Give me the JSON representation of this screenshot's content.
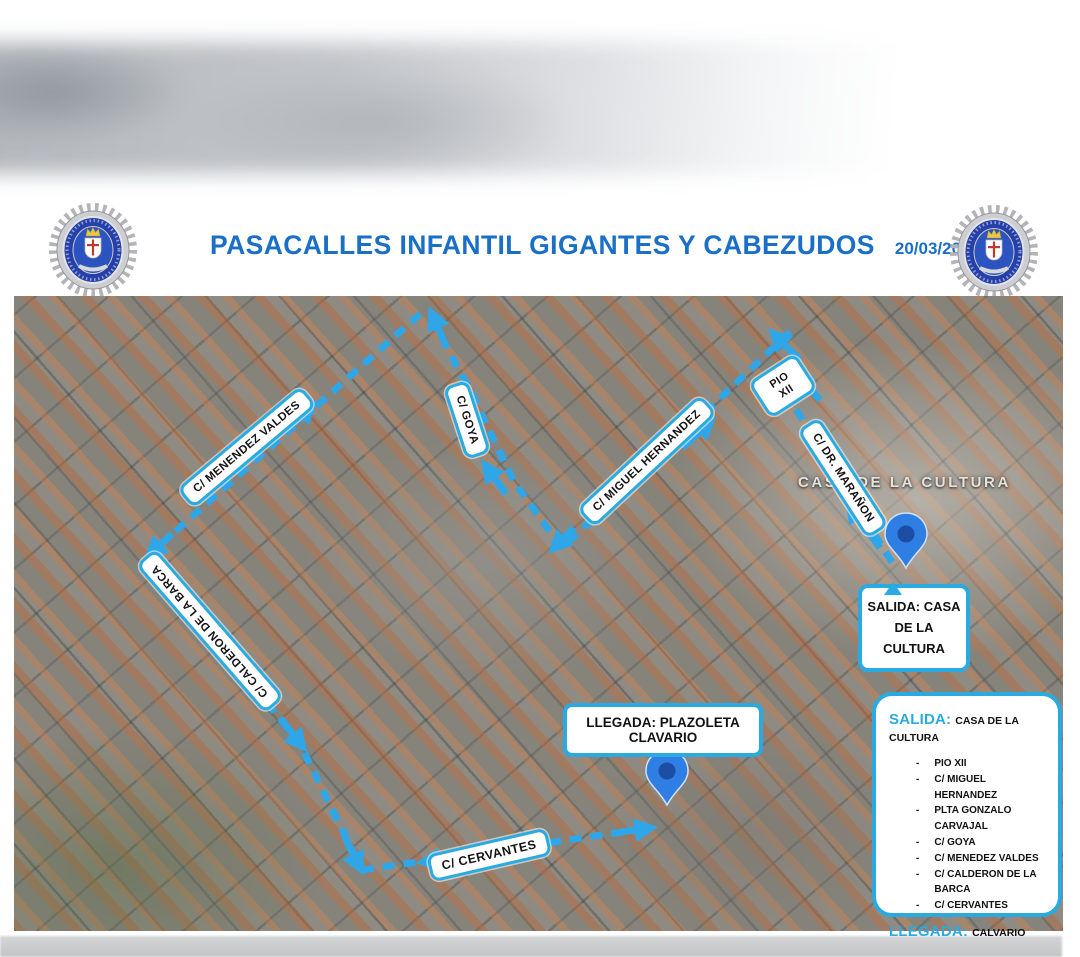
{
  "header": {
    "title": "PASACALLES INFANTIL GIGANTES Y CABEZUDOS",
    "date": "20/03/2026"
  },
  "map": {
    "place_label": "CASA DE LA CULTURA",
    "street_labels": {
      "menendez_valdes": "C/ MENENDEZ VALDES",
      "goya": "C/ GOYA",
      "miguel_hernandez": "C/ MIGUEL HERNANDEZ",
      "pio_xii": "PIO XII",
      "dr_maranon": "C/ DR. MARAÑON",
      "calderon": "C/ CALDERON DE LA BARCA",
      "cervantes": "C/ CERVANTES"
    },
    "callouts": {
      "salida": "SALIDA: CASA DE LA CULTURA",
      "llegada": "LLEGADA: PLAZOLETA CLAVARIO"
    }
  },
  "legend": {
    "salida_label": "SALIDA:",
    "salida_value": "CASA DE LA CULTURA",
    "route": [
      "PIO XII",
      "C/ MIGUEL HERNANDEZ",
      "PLTA GONZALO CARVAJAL",
      "C/ GOYA",
      "C/ MENEDEZ VALDES",
      "C/ CALDERON DE LA BARCA",
      "C/ CERVANTES"
    ],
    "llegada_label": "LLEGADA:",
    "llegada_value": "CALVARIO"
  },
  "colors": {
    "accent_blue": "#29ABE2",
    "route_blue": "#2FA6E8",
    "title_blue": "#1A6FC6",
    "pin_fill": "#2E7EE3",
    "pin_core": "#1C4FA4"
  }
}
